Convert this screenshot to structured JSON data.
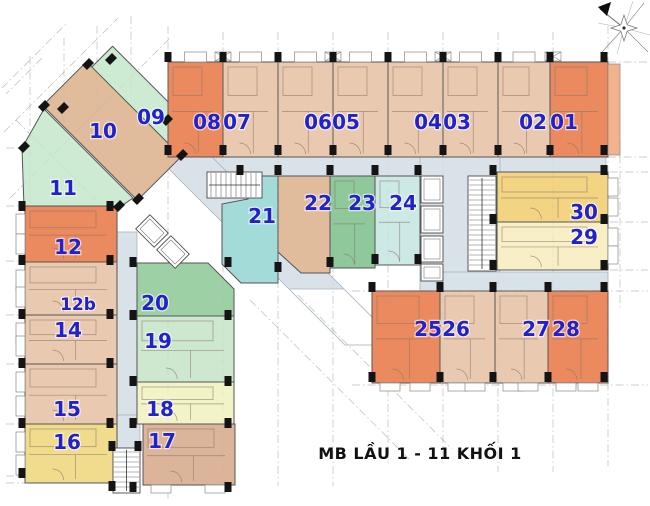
{
  "title": {
    "text": "MB  LẦU 1 - 11 KHỐI 1"
  },
  "compass": {
    "name": "compass-rose",
    "north": "upper-left"
  },
  "palette": {
    "orange": "#eb8a5f",
    "tan": "#e9cab0",
    "tan2": "#e0bb9c",
    "tan3": "#dcb49a",
    "palegreen": "#cdebd2",
    "green19": "#cde8cf",
    "green20": "#9ed0a6",
    "green23": "#8fc89b",
    "cyan21": "#a3dbd8",
    "cyan24": "#cde9e6",
    "yellow16": "#f0dc8c",
    "paleyellow": "#f3f3c8",
    "yellow30": "#f2d483",
    "yellow29": "#f8efc6",
    "balcony01": "#f2b28e",
    "corridor": "#d8e2e8",
    "corridor_stroke": "#a7b4bc",
    "wall": "#555555",
    "inner_wall": "#8a7668",
    "column": "#141414",
    "grid": "#8f98a3",
    "label_blue": "#2121cd",
    "title_black": "#111111"
  },
  "units": [
    {
      "id": "09",
      "shape": {
        "t": "rr",
        "cx": 138,
        "cy": 100,
        "w": 112,
        "h": 40,
        "a": 45
      },
      "c": "palegreen",
      "lx": 151,
      "ly": 117
    },
    {
      "id": "10",
      "shape": {
        "t": "rr",
        "cx": 112,
        "cy": 131,
        "w": 134,
        "h": 62,
        "a": 45
      },
      "c": "tan2",
      "lx": 103,
      "ly": 131
    },
    {
      "id": "11",
      "shape": {
        "t": "p",
        "pts": [
          [
            44,
            109
          ],
          [
            133,
            198
          ],
          [
            120,
            207
          ],
          [
            24,
            207
          ],
          [
            22,
            148
          ]
        ]
      },
      "c": "palegreen",
      "lx": 63,
      "ly": 188
    },
    {
      "id": "08",
      "shape": {
        "t": "r",
        "x": 168,
        "y": 62,
        "w": 55,
        "h": 95
      },
      "c": "orange",
      "lx": 207,
      "ly": 122,
      "bal": "top"
    },
    {
      "id": "07",
      "shape": {
        "t": "r",
        "x": 223,
        "y": 62,
        "w": 55,
        "h": 95
      },
      "c": "tan",
      "lx": 237,
      "ly": 122,
      "bal": "top"
    },
    {
      "id": "06",
      "shape": {
        "t": "r",
        "x": 278,
        "y": 62,
        "w": 55,
        "h": 95
      },
      "c": "tan",
      "lx": 318,
      "ly": 122,
      "bal": "top"
    },
    {
      "id": "05",
      "shape": {
        "t": "r",
        "x": 333,
        "y": 62,
        "w": 55,
        "h": 95
      },
      "c": "tan",
      "lx": 346,
      "ly": 122,
      "bal": "top"
    },
    {
      "id": "04",
      "shape": {
        "t": "r",
        "x": 388,
        "y": 62,
        "w": 55,
        "h": 95
      },
      "c": "tan",
      "lx": 428,
      "ly": 122,
      "bal": "top"
    },
    {
      "id": "03",
      "shape": {
        "t": "r",
        "x": 443,
        "y": 62,
        "w": 55,
        "h": 95
      },
      "c": "tan",
      "lx": 457,
      "ly": 122,
      "bal": "top"
    },
    {
      "id": "02",
      "shape": {
        "t": "r",
        "x": 498,
        "y": 62,
        "w": 52,
        "h": 95
      },
      "c": "tan",
      "lx": 533,
      "ly": 122,
      "bal": "top"
    },
    {
      "id": "01",
      "shape": {
        "t": "r",
        "x": 550,
        "y": 62,
        "w": 58,
        "h": 95
      },
      "c": "orange",
      "lx": 564,
      "ly": 122,
      "bal": "strip01"
    },
    {
      "id": "12",
      "shape": {
        "t": "r",
        "x": 25,
        "y": 206,
        "w": 92,
        "h": 56
      },
      "c": "orange",
      "lx": 68,
      "ly": 247,
      "bal": "left"
    },
    {
      "id": "12b",
      "shape": {
        "t": "r",
        "x": 25,
        "y": 262,
        "w": 92,
        "h": 53
      },
      "c": "tan",
      "lx": 78,
      "ly": 303,
      "bal": "left"
    },
    {
      "id": "14",
      "shape": {
        "t": "r",
        "x": 25,
        "y": 315,
        "w": 92,
        "h": 49
      },
      "c": "tan",
      "lx": 68,
      "ly": 330,
      "bal": "left"
    },
    {
      "id": "15",
      "shape": {
        "t": "r",
        "x": 25,
        "y": 364,
        "w": 92,
        "h": 60
      },
      "c": "tan",
      "lx": 67,
      "ly": 409,
      "bal": "left"
    },
    {
      "id": "16",
      "shape": {
        "t": "r",
        "x": 25,
        "y": 424,
        "w": 92,
        "h": 59
      },
      "c": "yellow16",
      "lx": 67,
      "ly": 442,
      "bal": "left"
    },
    {
      "id": "20",
      "shape": {
        "t": "p",
        "pts": [
          [
            137,
            263
          ],
          [
            208,
            263
          ],
          [
            234,
            289
          ],
          [
            234,
            316
          ],
          [
            137,
            316
          ]
        ]
      },
      "c": "green20",
      "lx": 155,
      "ly": 303
    },
    {
      "id": "19",
      "shape": {
        "t": "r",
        "x": 137,
        "y": 316,
        "w": 97,
        "h": 66
      },
      "c": "green19",
      "lx": 158,
      "ly": 341
    },
    {
      "id": "18",
      "shape": {
        "t": "r",
        "x": 137,
        "y": 382,
        "w": 97,
        "h": 42
      },
      "c": "paleyellow",
      "lx": 160,
      "ly": 409
    },
    {
      "id": "17",
      "shape": {
        "t": "r",
        "x": 143,
        "y": 424,
        "w": 92,
        "h": 61
      },
      "c": "tan3",
      "lx": 162,
      "ly": 441,
      "bal": "bottom"
    },
    {
      "id": "21",
      "shape": {
        "t": "p",
        "pts": [
          [
            248,
            176
          ],
          [
            278,
            176
          ],
          [
            278,
            283
          ],
          [
            241,
            283
          ],
          [
            222,
            264
          ],
          [
            222,
            204
          ],
          [
            248,
            199
          ]
        ]
      },
      "c": "cyan21",
      "lx": 262,
      "ly": 216
    },
    {
      "id": "22",
      "shape": {
        "t": "p",
        "pts": [
          [
            278,
            176
          ],
          [
            330,
            176
          ],
          [
            330,
            273
          ],
          [
            301,
            273
          ],
          [
            278,
            252
          ]
        ]
      },
      "c": "tan2",
      "lx": 318,
      "ly": 203
    },
    {
      "id": "23",
      "shape": {
        "t": "r",
        "x": 330,
        "y": 176,
        "w": 45,
        "h": 92
      },
      "c": "green23",
      "lx": 362,
      "ly": 203
    },
    {
      "id": "24",
      "shape": {
        "t": "r",
        "x": 375,
        "y": 176,
        "w": 45,
        "h": 89
      },
      "c": "cyan24",
      "lx": 403,
      "ly": 203
    },
    {
      "id": "30",
      "shape": {
        "t": "r",
        "x": 497,
        "y": 172,
        "w": 111,
        "h": 50
      },
      "c": "yellow30",
      "lx": 584,
      "ly": 212,
      "bal": "right"
    },
    {
      "id": "29",
      "shape": {
        "t": "r",
        "x": 497,
        "y": 222,
        "w": 111,
        "h": 48
      },
      "c": "yellow29",
      "lx": 584,
      "ly": 237,
      "bal": "right"
    },
    {
      "id": "25",
      "shape": {
        "t": "r",
        "x": 372,
        "y": 291,
        "w": 68,
        "h": 92
      },
      "c": "orange",
      "lx": 428,
      "ly": 329,
      "bal": "bottom"
    },
    {
      "id": "26",
      "shape": {
        "t": "r",
        "x": 440,
        "y": 291,
        "w": 55,
        "h": 92
      },
      "c": "tan",
      "lx": 456,
      "ly": 329,
      "bal": "bottom"
    },
    {
      "id": "27",
      "shape": {
        "t": "r",
        "x": 495,
        "y": 291,
        "w": 53,
        "h": 92
      },
      "c": "tan",
      "lx": 536,
      "ly": 329,
      "bal": "bottom"
    },
    {
      "id": "28",
      "shape": {
        "t": "r",
        "x": 548,
        "y": 291,
        "w": 60,
        "h": 92
      },
      "c": "orange",
      "lx": 566,
      "ly": 329,
      "bal": "bottom"
    }
  ],
  "corridors": [
    {
      "t": "r",
      "x": 178,
      "y": 157,
      "w": 428,
      "h": 20
    },
    {
      "t": "p",
      "pts": [
        [
          157,
          157
        ],
        [
          212,
          157
        ],
        [
          344,
          289
        ],
        [
          289,
          289
        ]
      ]
    },
    {
      "t": "r",
      "x": 113,
      "y": 232,
      "w": 24,
      "h": 222
    },
    {
      "t": "r",
      "x": 420,
      "y": 157,
      "w": 80,
      "h": 135
    },
    {
      "t": "r",
      "x": 420,
      "y": 272,
      "w": 188,
      "h": 19
    },
    {
      "t": "r",
      "x": 112,
      "y": 415,
      "w": 28,
      "h": 33
    }
  ],
  "cores": {
    "stairs": [
      {
        "x": 207,
        "y": 172,
        "w": 55,
        "h": 26,
        "dir": "h"
      },
      {
        "x": 468,
        "y": 176,
        "w": 28,
        "h": 95,
        "dir": "v"
      },
      {
        "x": 113,
        "y": 448,
        "w": 27,
        "h": 45,
        "dir": "v"
      }
    ],
    "elevators": [
      {
        "x": 421,
        "y": 176,
        "w": 22,
        "h": 27
      },
      {
        "x": 421,
        "y": 206,
        "w": 22,
        "h": 27
      },
      {
        "x": 421,
        "y": 236,
        "w": 22,
        "h": 26
      },
      {
        "x": 421,
        "y": 264,
        "w": 22,
        "h": 17
      }
    ],
    "elevators_rotated": [
      {
        "cx": 152,
        "cy": 231,
        "w": 26,
        "h": 20,
        "a": 45
      },
      {
        "cx": 173,
        "cy": 252,
        "w": 26,
        "h": 20,
        "a": 45
      }
    ]
  }
}
